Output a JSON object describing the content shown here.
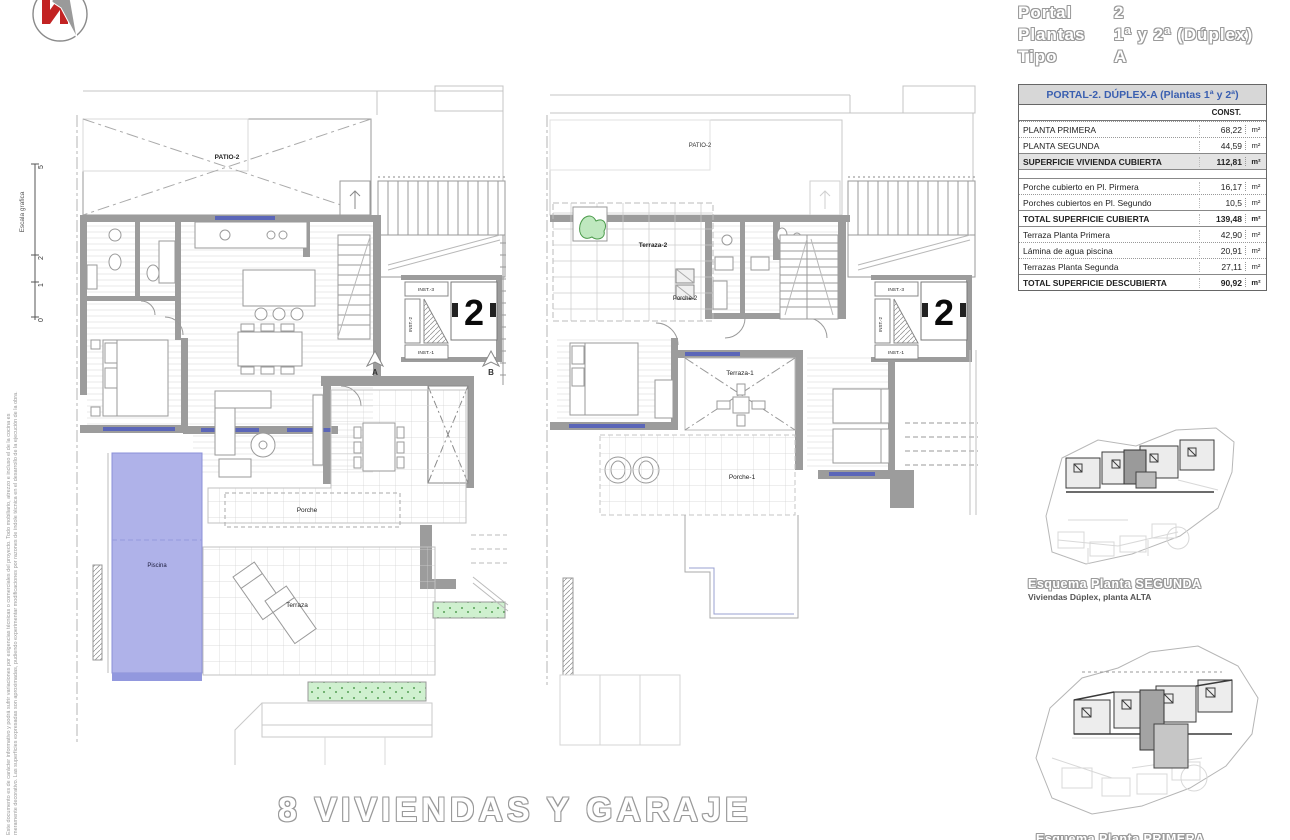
{
  "header": {
    "rows": [
      {
        "label": "Portal",
        "value": "2"
      },
      {
        "label": "Plantas",
        "value": "1ª y 2ª (Dúplex)"
      },
      {
        "label": "Tipo",
        "value": "A"
      }
    ]
  },
  "table": {
    "title": "PORTAL-2. DÚPLEX-A (Plantas 1ª y 2ª)",
    "col_header": "CONST.",
    "unit": "m²",
    "rows": [
      {
        "label": "PLANTA PRIMERA",
        "value": "68,22"
      },
      {
        "label": "PLANTA SEGUNDA",
        "value": "44,59"
      },
      {
        "label": "SUPERFICIE VIVIENDA CUBIERTA",
        "value": "112,81"
      },
      {
        "label": "Porche cubierto en Pl. Pirmera",
        "value": "16,17"
      },
      {
        "label": "Porches cubiertos en Pl. Segundo",
        "value": "10,5"
      },
      {
        "label": "TOTAL SUPERFICIE CUBIERTA",
        "value": "139,48"
      },
      {
        "label": "Terraza Planta Primera",
        "value": "42,90"
      },
      {
        "label": "Lámina de agua piscina",
        "value": "20,91"
      },
      {
        "label": "Terrazas Planta Segunda",
        "value": "27,11"
      },
      {
        "label": "TOTAL SUPERFICIE DESCUBIERTA",
        "value": "90,92"
      }
    ]
  },
  "scale_bar": {
    "label": "Escala grafica",
    "ticks": [
      "0",
      "1",
      "2",
      "5"
    ]
  },
  "disclaimer": {
    "text": "Este documento es de carácter informativo y podrá sufrir variaciones por exigencias técnicas o comerciales del proyecto. Todo mobiliario, atrezzo e incluso el de la cocina es meramente decorativo. Las superficies expresadas son aproximadas, pudiendo experimentar modificaciones por razones de índole técnica en el desarrollo de la ejecución de la obra."
  },
  "plan_first": {
    "patio": "PATIO-2",
    "porche": "Porche",
    "terraza": "Terraza",
    "piscina": "Piscina",
    "unit_number": "2",
    "inst3": "INST.-3",
    "inst2": "INST.-2",
    "inst1": "INST.-1",
    "marker_a": "A",
    "marker_b": "B"
  },
  "plan_second": {
    "patio": "PATIO-2",
    "terraza2": "Terraza-2",
    "porche2": "Porche-2",
    "terraza1": "Terraza-1",
    "porche1": "Porche-1",
    "unit_number": "2",
    "inst3": "INST.-3",
    "inst2": "INST.-2",
    "inst1": "INST.-1"
  },
  "site_plan_upper": {
    "caption_title": "Esquema Planta SEGUNDA",
    "caption_subtitle": "Viviendas Dúplex, planta ALTA"
  },
  "site_plan_lower": {
    "caption_title": "Esquema Planta PRIMERA"
  },
  "footer": {
    "title": "8 VIVIENDAS Y GARAJES"
  },
  "colors": {
    "pool": "#afb2e9",
    "planter": "#cff0cf",
    "wall": "#9c9c9c",
    "window": "#5b66b8",
    "table_title": "#3a5fb0"
  }
}
